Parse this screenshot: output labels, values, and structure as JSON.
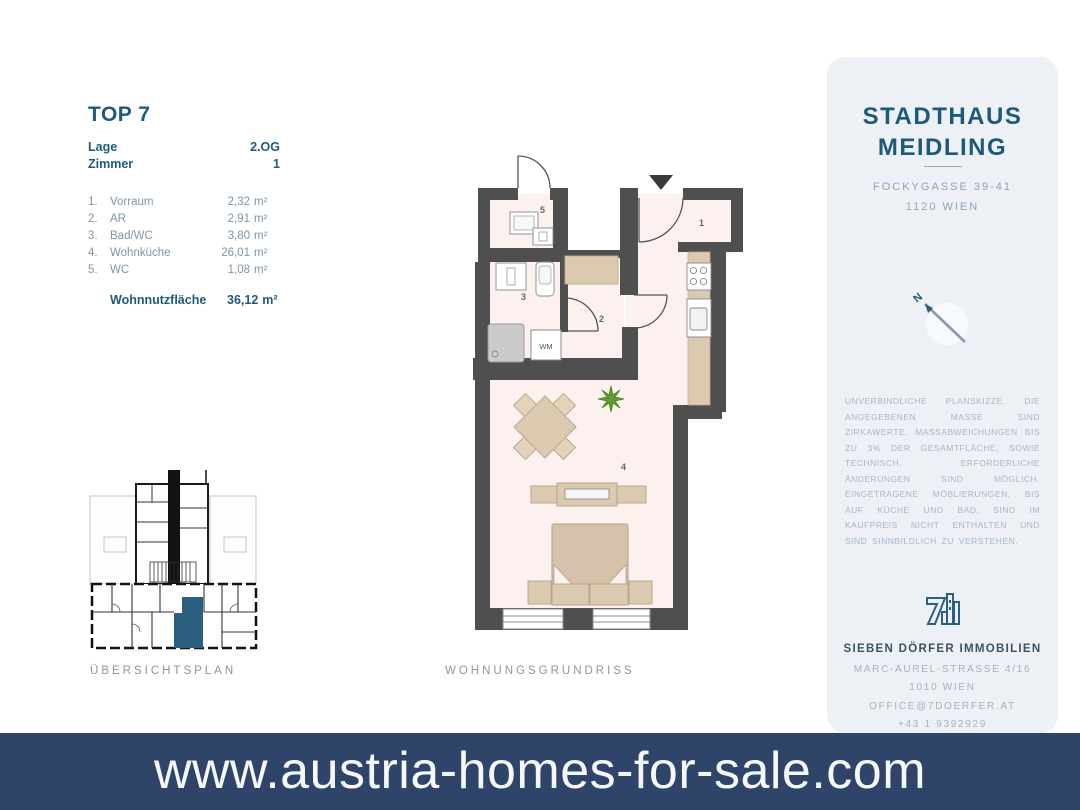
{
  "banner": {
    "url_text": "www.austria-homes-for-sale.com"
  },
  "unit_info": {
    "title": "TOP 7",
    "meta": [
      {
        "label": "Lage",
        "value": "2.OG"
      },
      {
        "label": "Zimmer",
        "value": "1"
      }
    ],
    "rooms": [
      {
        "num": "1.",
        "name": "Vorraum",
        "area": "2,32",
        "unit": "m²"
      },
      {
        "num": "2.",
        "name": "AR",
        "area": "2,91",
        "unit": "m²"
      },
      {
        "num": "3.",
        "name": "Bad/WC",
        "area": "3,80",
        "unit": "m²"
      },
      {
        "num": "4.",
        "name": "Wohnküche",
        "area": "26,01",
        "unit": "m²"
      },
      {
        "num": "5.",
        "name": "WC",
        "area": "1,08",
        "unit": "m²"
      }
    ],
    "total": {
      "label": "Wohnnutzfläche",
      "area": "36,12",
      "unit": "m²"
    }
  },
  "plans": {
    "overview_label": "ÜBERSICHTSPLAN",
    "floorplan_label": "WOHNUNGSGRUNDRISS",
    "room_numbers": [
      "1",
      "2",
      "3",
      "4",
      "5"
    ],
    "wm_label": "WM",
    "compass_label": "N"
  },
  "panel": {
    "project_title_line1": "STADTHAUS",
    "project_title_line2": "MEIDLING",
    "address_line1": "FOCKYGASSE 39-41",
    "address_line2": "1120 WIEN",
    "disclaimer": "UNVERBINDLICHE PLANSKIZZE. DIE ANGEGEBENEN MASSE SIND ZIRKAWERTE. MASSABWEICHUNGEN BIS ZU 3% DER GESAMTFLÄCHE, SOWIE TECHNISCH, ERFORDERLICHE ÄNDERUNGEN SIND MÖGLICH. EINGETRAGENE MÖBLIERUNGEN, BIS AUF KÜCHE UND BAD, SIND IM KAUFPREIS NICHT ENTHALTEN UND SIND SINNBILDLICH ZU VERSTEHEN.",
    "company": "SIEBEN DÖRFER IMMOBILIEN",
    "company_address_line1": "MARC-AUREL-STRASSE 4/16",
    "company_address_line2": "1010 WIEN",
    "email": "OFFICE@7DOERFER.AT",
    "phone": "+43 1 9392929"
  },
  "colors": {
    "accent": "#1d5a7a",
    "banner_bg": "#2e4569",
    "panel_bg": "#edf1f6",
    "wall": "#4f4f4f",
    "floor": "#fcf1ef",
    "furniture": "#dccab0",
    "highlight_unit": "#2b5f80"
  }
}
